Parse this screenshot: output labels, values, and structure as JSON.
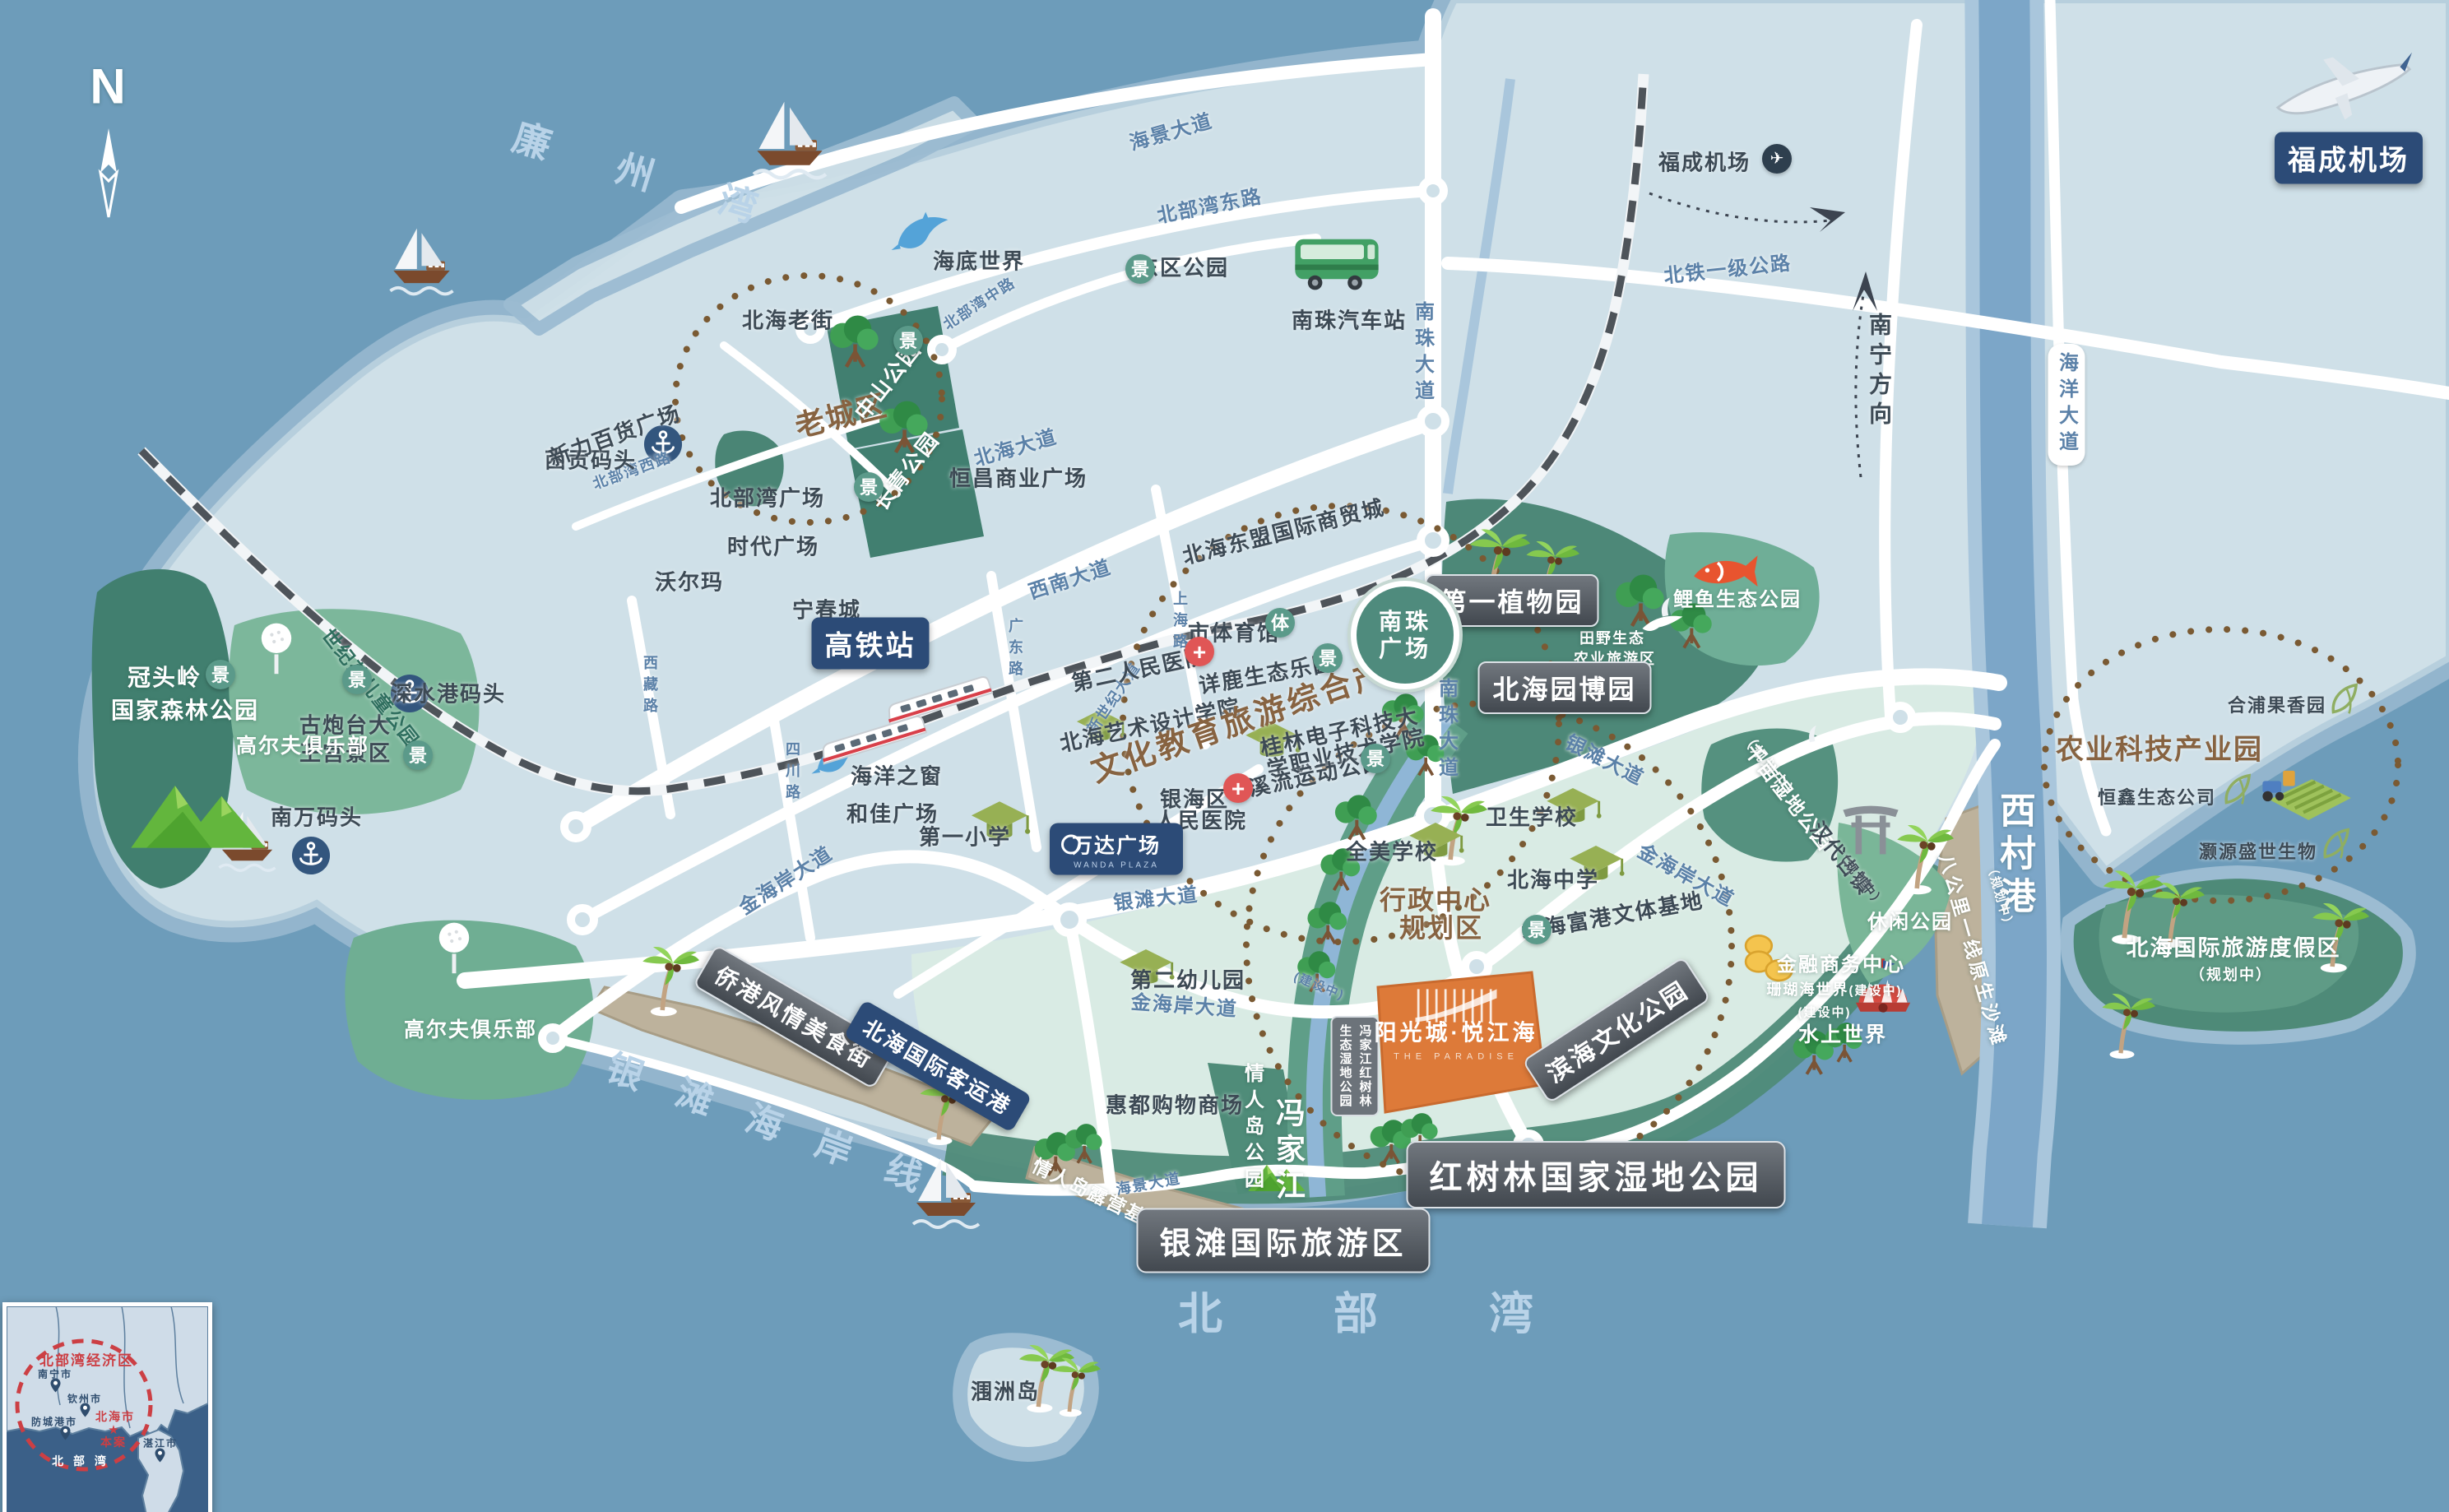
{
  "colors": {
    "sea": "#6d9cba",
    "land": "#cfe0e8",
    "mint": "#d9ebe4",
    "park": "#4d8878",
    "sand": "#bdb29c",
    "river": "#7ca6c8",
    "accent_orange": "#dd7a39",
    "label_dark": "#42484f",
    "label_blue": "#2c4b77",
    "dotted_circle": "#7a5a33",
    "inset_red": "#cc3f44"
  },
  "compass": {
    "n": "N"
  },
  "badges": {
    "scenic": "景",
    "sport": "体",
    "hospital": "+",
    "plane": "✈",
    "star": "★"
  },
  "sea_labels": {
    "lianzhou_bay": "廉 州 湾",
    "yintan_coastline": "银滩海岸线",
    "beibu_gulf": "北 部 湾",
    "xicun_port": "西村港",
    "fengjia_river": "冯家江"
  },
  "roads": {
    "haijing": "海景大道",
    "beibuwan_east": "北部湾东路",
    "beibuwan_mid": "北部湾中路",
    "beibuwan_west": "北部湾西路",
    "beihai": "北海大道",
    "xinan": "西南大道",
    "shanghai": "上海路",
    "guangdong": "广东路",
    "sichuan": "四川路",
    "xizang": "西藏路",
    "xinshiji": "新世纪大道",
    "nanzhu": "南珠大道",
    "yintan": "银滩大道",
    "jinhaian": "金海岸大道",
    "beitie": "北铁一级公路",
    "haiyang": "海洋大道",
    "nanning_dir": "南宁方向",
    "under_construction": "(建设中)",
    "planning": "（规划中）"
  },
  "stations": {
    "hsr": "高铁站",
    "coach": "南珠汽车站",
    "ferry": "北海国际客运港",
    "airport": "福成机场"
  },
  "zones": {
    "old_town": "老城区",
    "culture": "文化教育旅游综合产业区",
    "admin1": "行政中心",
    "admin2": "规划区",
    "agri": "农业科技产业园"
  },
  "pois": {
    "xigong_wharf": "西贡码头",
    "beihai_old_street": "北海老街",
    "deepwater_wharf": "深水港码头",
    "fort1": "古炮台大",
    "fort2": "王宫景区",
    "xinli_plaza": "新力百货广场",
    "beibuwan_plaza": "北部湾广场",
    "shidai_plaza": "时代广场",
    "walmart": "沃尔玛",
    "ningchun_city": "宁春城",
    "hengchang_plaza": "恒昌商业广场",
    "dongmeng_mall": "北海东盟国际商贸城",
    "sports_hall": "市体育馆",
    "xianglu_park": "详鹿生态乐园",
    "no2_hospital": "第二人民医院",
    "art_college": "北海艺术设计学院",
    "guilin1": "桂林电子科技大",
    "guilin2": "学职业技术学院",
    "stream_park": "溪流运动公园",
    "yinhai1": "银海区",
    "yinhai2": "人民医院",
    "nanzhu1": "南珠",
    "nanzhu2": "广场",
    "east_park": "东区公园",
    "undersea_world": "海底世界",
    "ocean_window": "海洋之窗",
    "hejia_plaza": "和佳广场",
    "no1_primary": "第一小学",
    "wanda1": "万达广场",
    "wanda2": "WANDA PLAZA",
    "health_school": "卫生学校",
    "beihai_middle": "北海中学",
    "quanmei_school": "全美学校",
    "fugang_base": "北海富港文体基地",
    "no2_kindergarten": "第二幼儿园",
    "huidu_mall": "惠都购物商场",
    "finance_center": "金融商务中心",
    "coral_world": "珊瑚海世界",
    "water_world": "水上世界",
    "hepu_garden": "合浦果香园",
    "hengxin_eco": "恒鑫生态公司",
    "haoyuan_bio": "灏源盛世生物",
    "nanwan_wharf": "南万码头",
    "weizhou_island": "涠洲岛"
  },
  "parks": {
    "guantouling1": "冠头岭",
    "guantouling2": "国家森林公园",
    "golf_club": "高尔夫俱乐部",
    "century_children": "世纪苑儿童公园",
    "zhongshan": "中山公园",
    "changqing": "长青公园",
    "botanical": "第一植物园",
    "yuanboyuan": "北海园博园",
    "tianye1": "田野生态",
    "tianye2": "农业旅游区",
    "koi_park": "鲤鱼生态公园",
    "qianmu_wetland": "千亩湿地公园",
    "handai_town": "汉代古镇",
    "leisure_park": "休闲公园",
    "bagongli": "八公里一线原生沙滩",
    "binhai_culture": "滨海文化公园",
    "mangrove_national": "红树林国家湿地公园",
    "yintan_tourist": "银滩国际旅游区",
    "qiaogang_food": "侨港风情美食街",
    "lovers_island": "情人岛公园",
    "lovers_camp": "情人岛露营基地",
    "resort": "北海国际旅游度假区",
    "fengjiang_label1": "冯家江红树林",
    "fengjiang_label2": "生态湿地公园"
  },
  "project": {
    "name": "阳光城·悦江海",
    "name_en": "THE PARADISE"
  },
  "inset": {
    "economic_zone": "北部湾经济区",
    "nanning": "南宁市",
    "qinzhou": "钦州市",
    "fangchenggang": "防城港市",
    "beihai": "北海市",
    "site": "本案",
    "zhanjiang": "湛江市",
    "gulf": "北 部 湾"
  }
}
